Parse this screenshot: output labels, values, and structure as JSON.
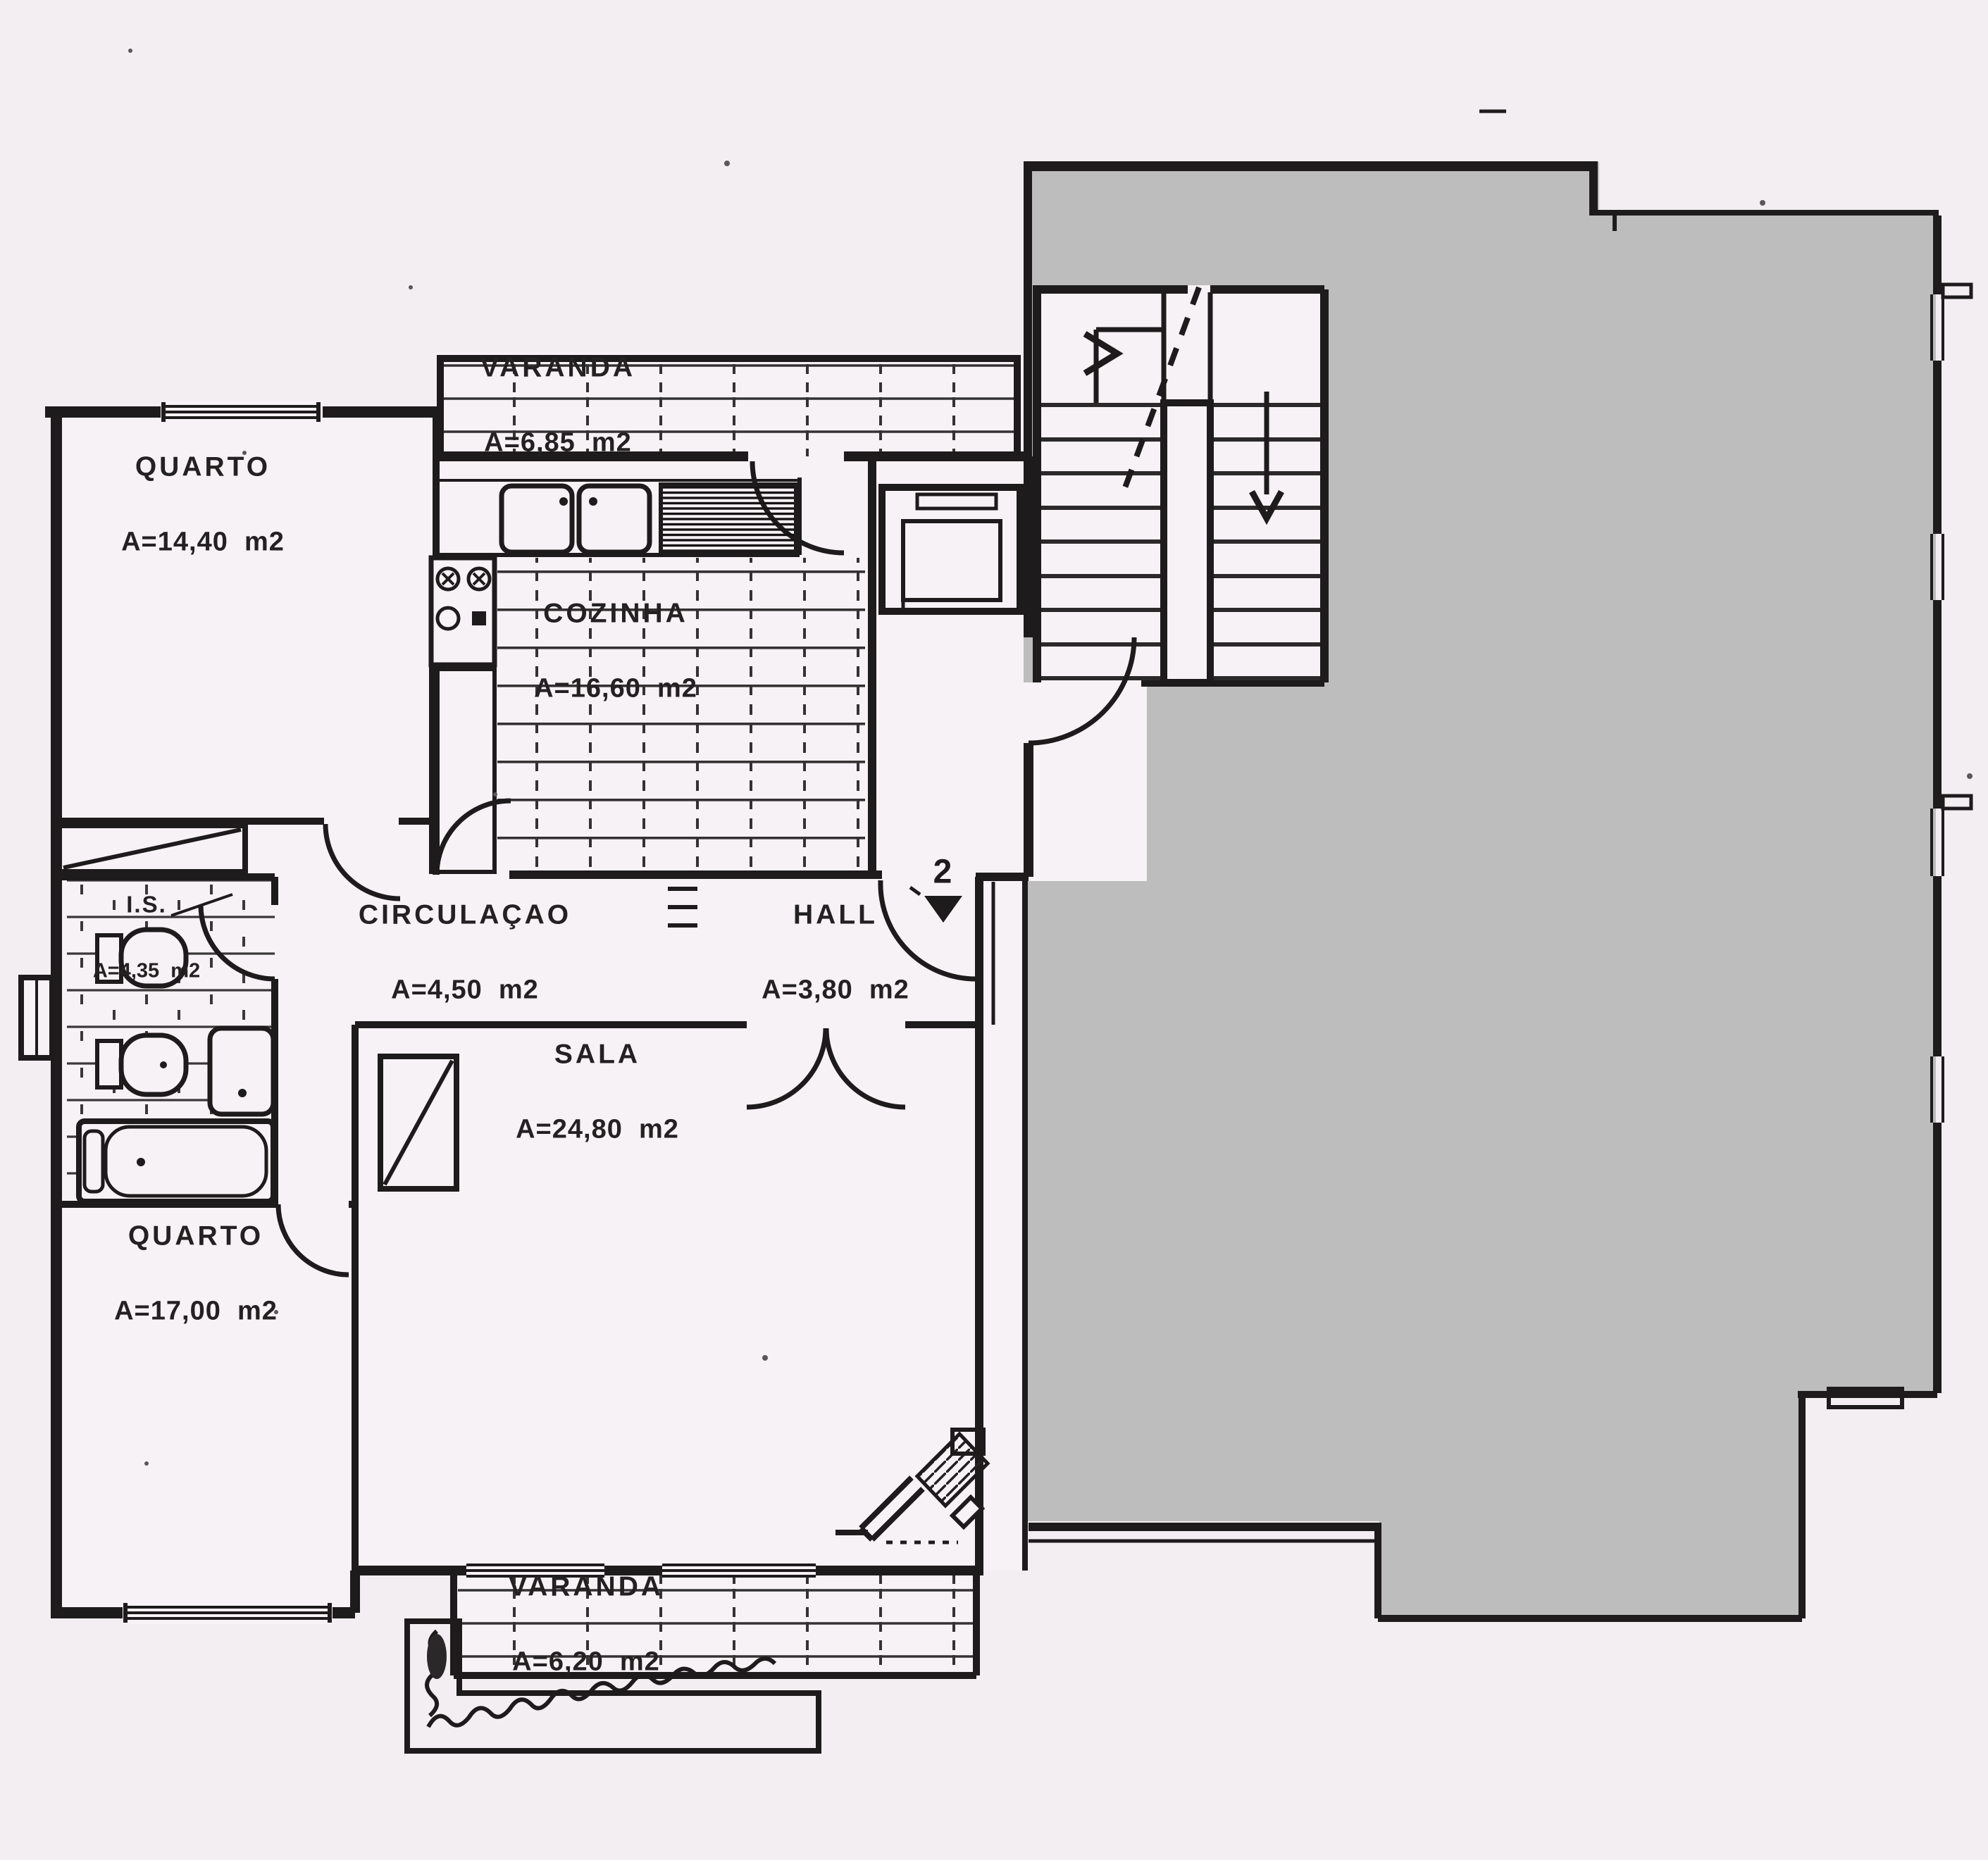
{
  "plan": {
    "rooms": {
      "varanda_top": {
        "name": "VARANDA",
        "area": "A=6,85  m2"
      },
      "quarto_top": {
        "name": "QUARTO",
        "area": "A=14,40  m2"
      },
      "cozinha": {
        "name": "COZINHA",
        "area": "A=16,60  m2"
      },
      "circulacao": {
        "name": "CIRCULAÇAO",
        "area": "A=4,50  m2"
      },
      "hall": {
        "name": "HALL",
        "area": "A=3,80  m2"
      },
      "instalacao_sanitaria": {
        "name": "I.S.",
        "area": "A=4,35  m2"
      },
      "sala": {
        "name": "SALA",
        "area": "A=24,80  m2"
      },
      "quarto_bottom": {
        "name": "QUARTO",
        "area": "A=17,00  m2"
      },
      "varanda_bottom": {
        "name": "VARANDA",
        "area": "A=6,20  m2"
      }
    },
    "markers": {
      "entrance_unit": "2"
    },
    "colors": {
      "paper": "#f2eef1",
      "plan_paper": "#f7f2f5",
      "ink": "#1d1b1c",
      "mask_gray": "#bdbdbd"
    }
  }
}
